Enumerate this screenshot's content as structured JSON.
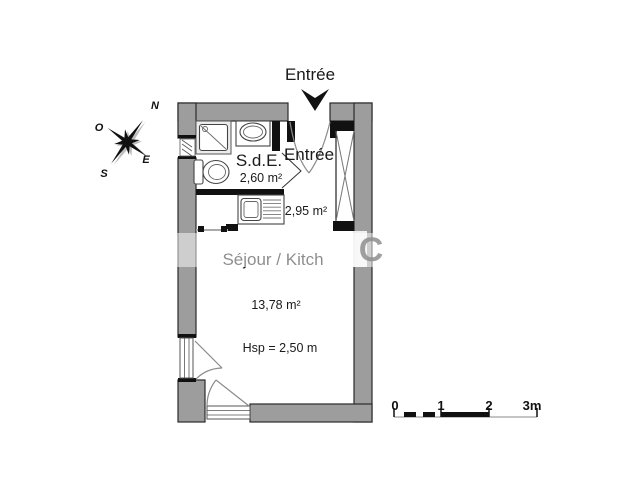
{
  "entrance": {
    "label": "Entrée",
    "arrow_icon": "arrow-down-icon"
  },
  "rooms": {
    "sde": {
      "name": "S.d.E.",
      "area": "2,60 m²"
    },
    "entree": {
      "name": "Entrée",
      "area": "2,95 m²"
    },
    "sejour": {
      "name": "Séjour / Kitch",
      "area": "13,78 m²",
      "ceiling_height": "Hsp = 2,50 m"
    }
  },
  "compass": {
    "north": "N",
    "west": "O",
    "east": "E",
    "south": "S"
  },
  "scale_bar": {
    "ticks": [
      "0",
      "1",
      "2",
      "3m"
    ]
  },
  "watermark": {
    "fragment": "C"
  },
  "colors": {
    "wall": "#9d9d9d",
    "line": "#111111",
    "shower_fill": "#ececec",
    "text": "#1a1a1a"
  }
}
